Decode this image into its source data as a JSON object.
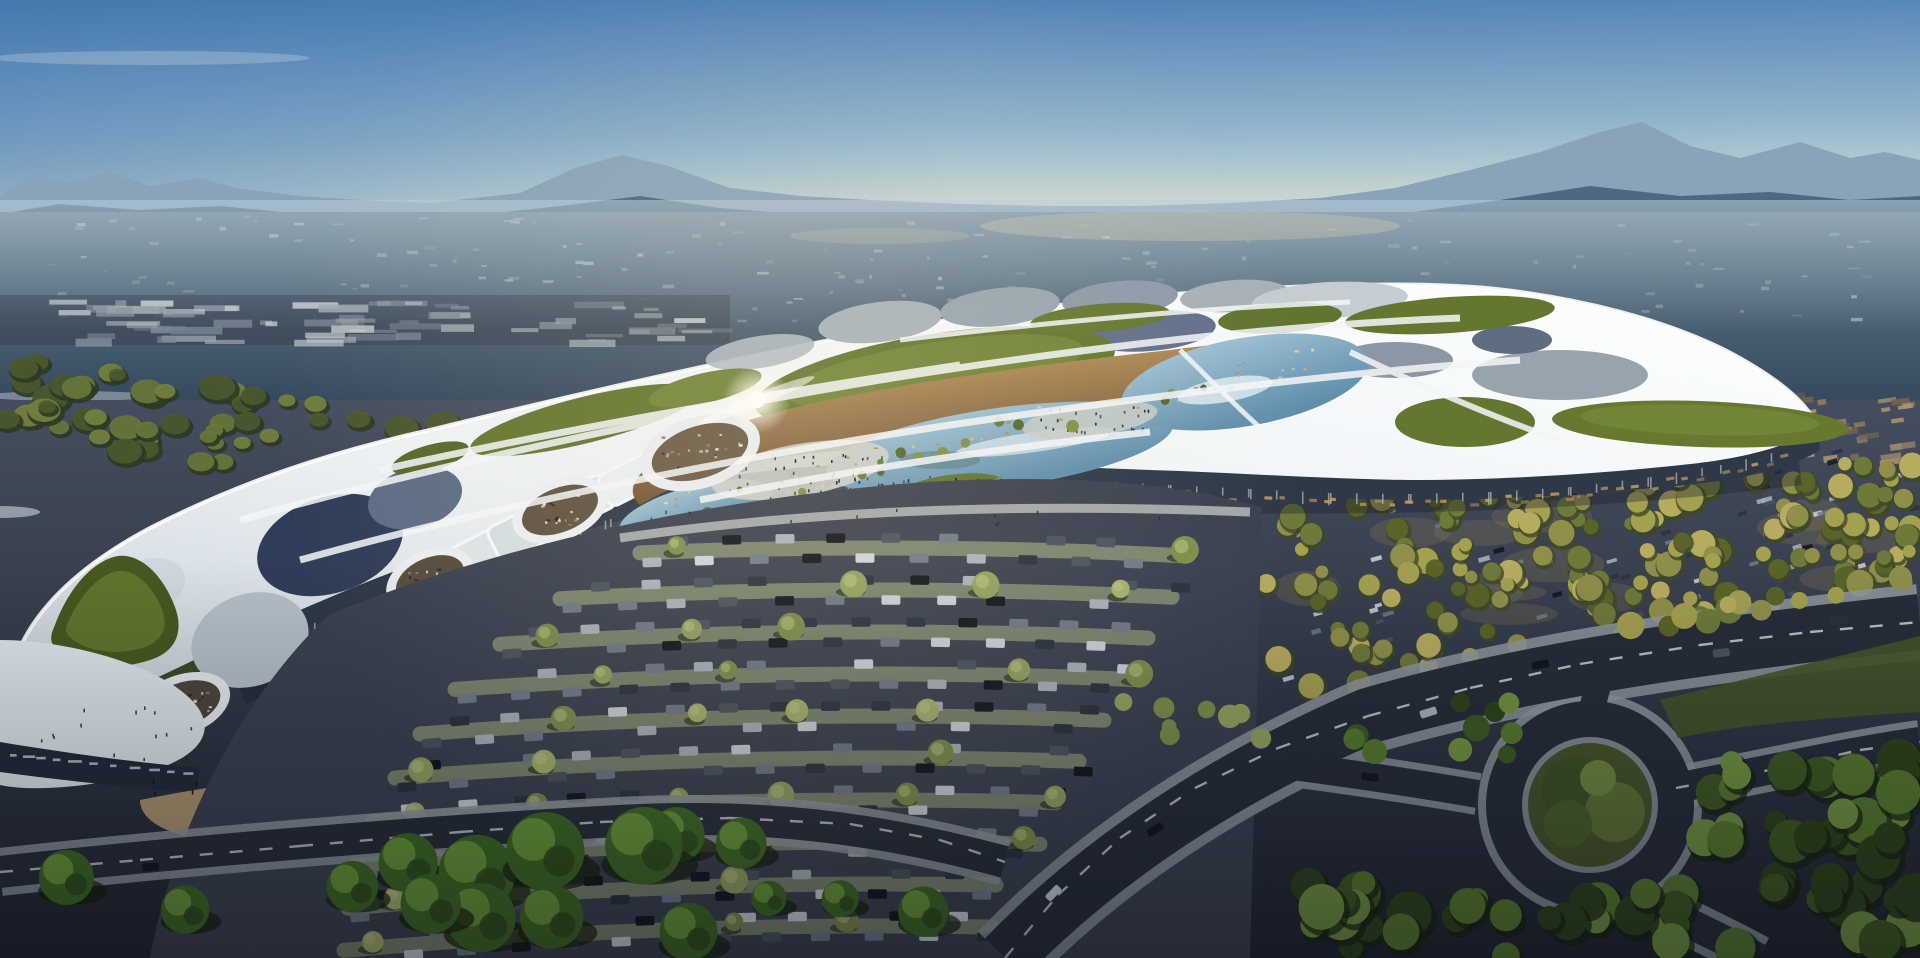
{
  "scene": {
    "title": "Aerial dusk rendering of a futuristic mall complex",
    "description": "Architectural visualization: organic white lattice roof with green roof gardens and glass panels, central lagoon courtyard with amber terraces and crowds, vast parking lots with tree rows, autumn tree grove parking, roundabout road network, hazy valley and mountain range at the horizon. No readable text is present (building signage is an illegible blur).",
    "features": [
      "sky-gradient",
      "mountain-ranges",
      "hazy-valley",
      "industrial-strip",
      "residential-district",
      "mall-building",
      "roof-garden-patches",
      "glass-roof-panels",
      "skylight-band",
      "lagoon-courtyard",
      "sun-glint",
      "entrance-plaza-with-people",
      "central-parking-lot",
      "east-tree-grove-parking",
      "roundabout",
      "roads-with-cars",
      "foreground-tree-row"
    ],
    "palette": {
      "sky_top": "#4a7cb2",
      "sky_mid": "#8fb3cb",
      "sky_horizon": "#ccd8d2",
      "horizon_warm": "#e3e6cd",
      "mountain_far": "#8aa3b8",
      "mountain_near": "#48627b",
      "valley_light": "#68808f",
      "valley_dark": "#33465a",
      "valley_patch": "#c2b28f",
      "industry_light": "#c5cdd2",
      "roof_shade": "#c7d1d9",
      "roof_white": "#edf1f4",
      "roof_bright": "#fbfdfe",
      "panel_light": "#b4bfc7",
      "panel_slate": "#5c6c84",
      "panel_dark": "#303d58",
      "skylight": "#dce4e5",
      "grass_roof": "#637730",
      "grass_roof_light": "#7e9440",
      "grass_roof_dark": "#45561f",
      "pond_light": "#a4c6d6",
      "pond_deep": "#608fad",
      "amber": "#95734a",
      "amber_dark": "#63492e",
      "amber_glow": "#d2a867",
      "plaza": "#ced1c9",
      "people": "#1d242e",
      "asphalt": "#3a4150",
      "stall": "#8c9675",
      "walkway": "#c5c9c5",
      "road": "#262d39",
      "sidewalk": "#8f99a1",
      "lane": "#dde3e6",
      "verge": "#45542b",
      "sand": "#b59c73",
      "sand_light": "#dac293",
      "sign_band": "#222b39",
      "facade_band": "#2d3947",
      "facade_glow": "#c79a5c",
      "ground_top": "#454e5e",
      "ground_bottom": "#1e2430",
      "tree_bright": "#3e6a23",
      "tree_bright_hi": "#71a03b",
      "tree_shadow": "#142008",
      "glint": "#ffffff"
    },
    "palette_sets": {
      "cars": [
        "#12161e",
        "#2b333f",
        "#49545f",
        "#6f7b88",
        "#a9b3bb",
        "#ccd4da"
      ],
      "autumn_trees": [
        "#8f8f4a",
        "#a3a050",
        "#b6ac60",
        "#6e7a3a",
        "#596428"
      ],
      "residential": [
        "#a98f6b",
        "#8f7a5e",
        "#74644e",
        "#b89a72"
      ],
      "band_trees": [
        "#4b5a2e",
        "#69793c",
        "#74843e"
      ],
      "row_trees": [
        "#93a35e",
        "#7c8f4a",
        "#a7b46b"
      ],
      "speckles": [
        "#b9c2c6",
        "#98a5ad",
        "#cdd4d6"
      ],
      "industry": [
        "#c5cdd2",
        "#9aa7ae",
        "#7b8893"
      ],
      "corner_trees": [
        "#3c5a22",
        "#567a2e",
        "#6f9440",
        "#2c441a"
      ]
    }
  }
}
